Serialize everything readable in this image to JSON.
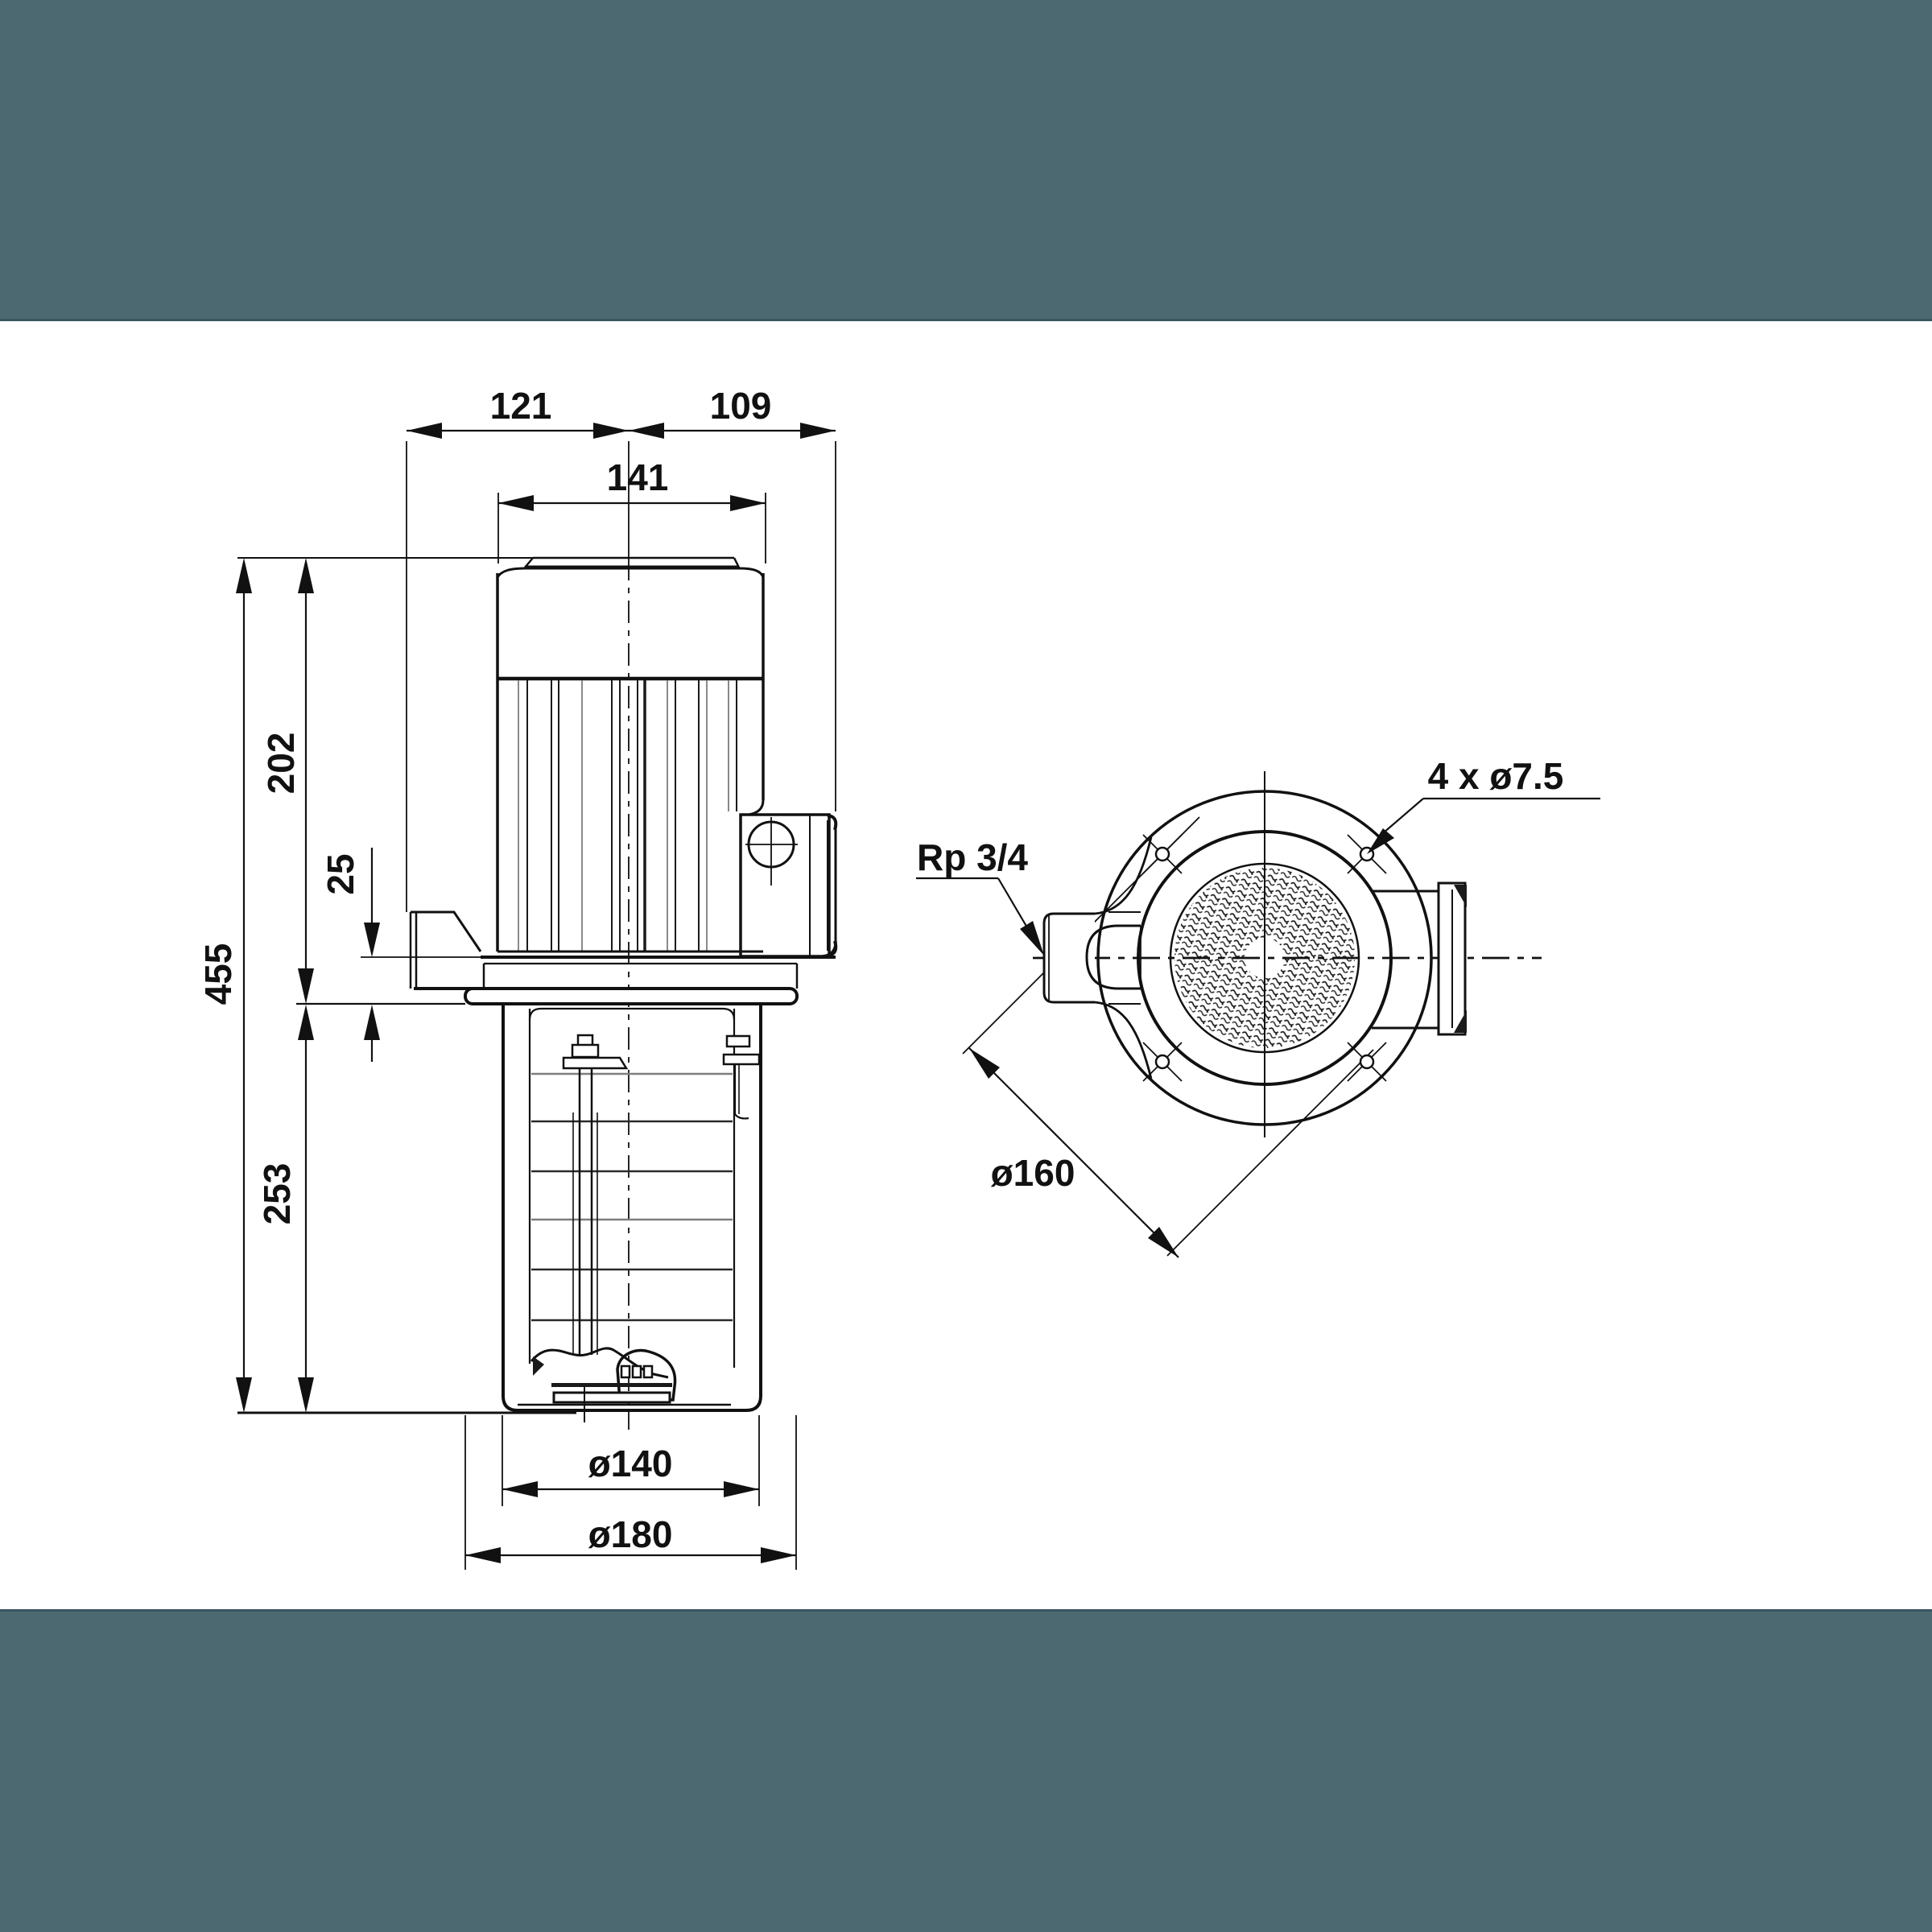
{
  "drawing": {
    "title": "pump-dimensional-drawing",
    "colors": {
      "band": "#4c6971",
      "band_edge": "#3a555f",
      "ink": "#111111",
      "paper": "#ffffff"
    },
    "side_view": {
      "dims": {
        "top_left_width": "121",
        "top_right_width": "109",
        "motor_width": "141",
        "motor_height": "202",
        "flange_offset": "25",
        "total_height": "455",
        "immersion_depth": "253",
        "sleeve_diameter": "ø140",
        "plate_diameter": "ø180"
      }
    },
    "top_view": {
      "dims": {
        "bolt_holes": "4 x ø7.5",
        "suction_port": "Rp 3/4",
        "bolt_circle": "ø160"
      }
    }
  }
}
